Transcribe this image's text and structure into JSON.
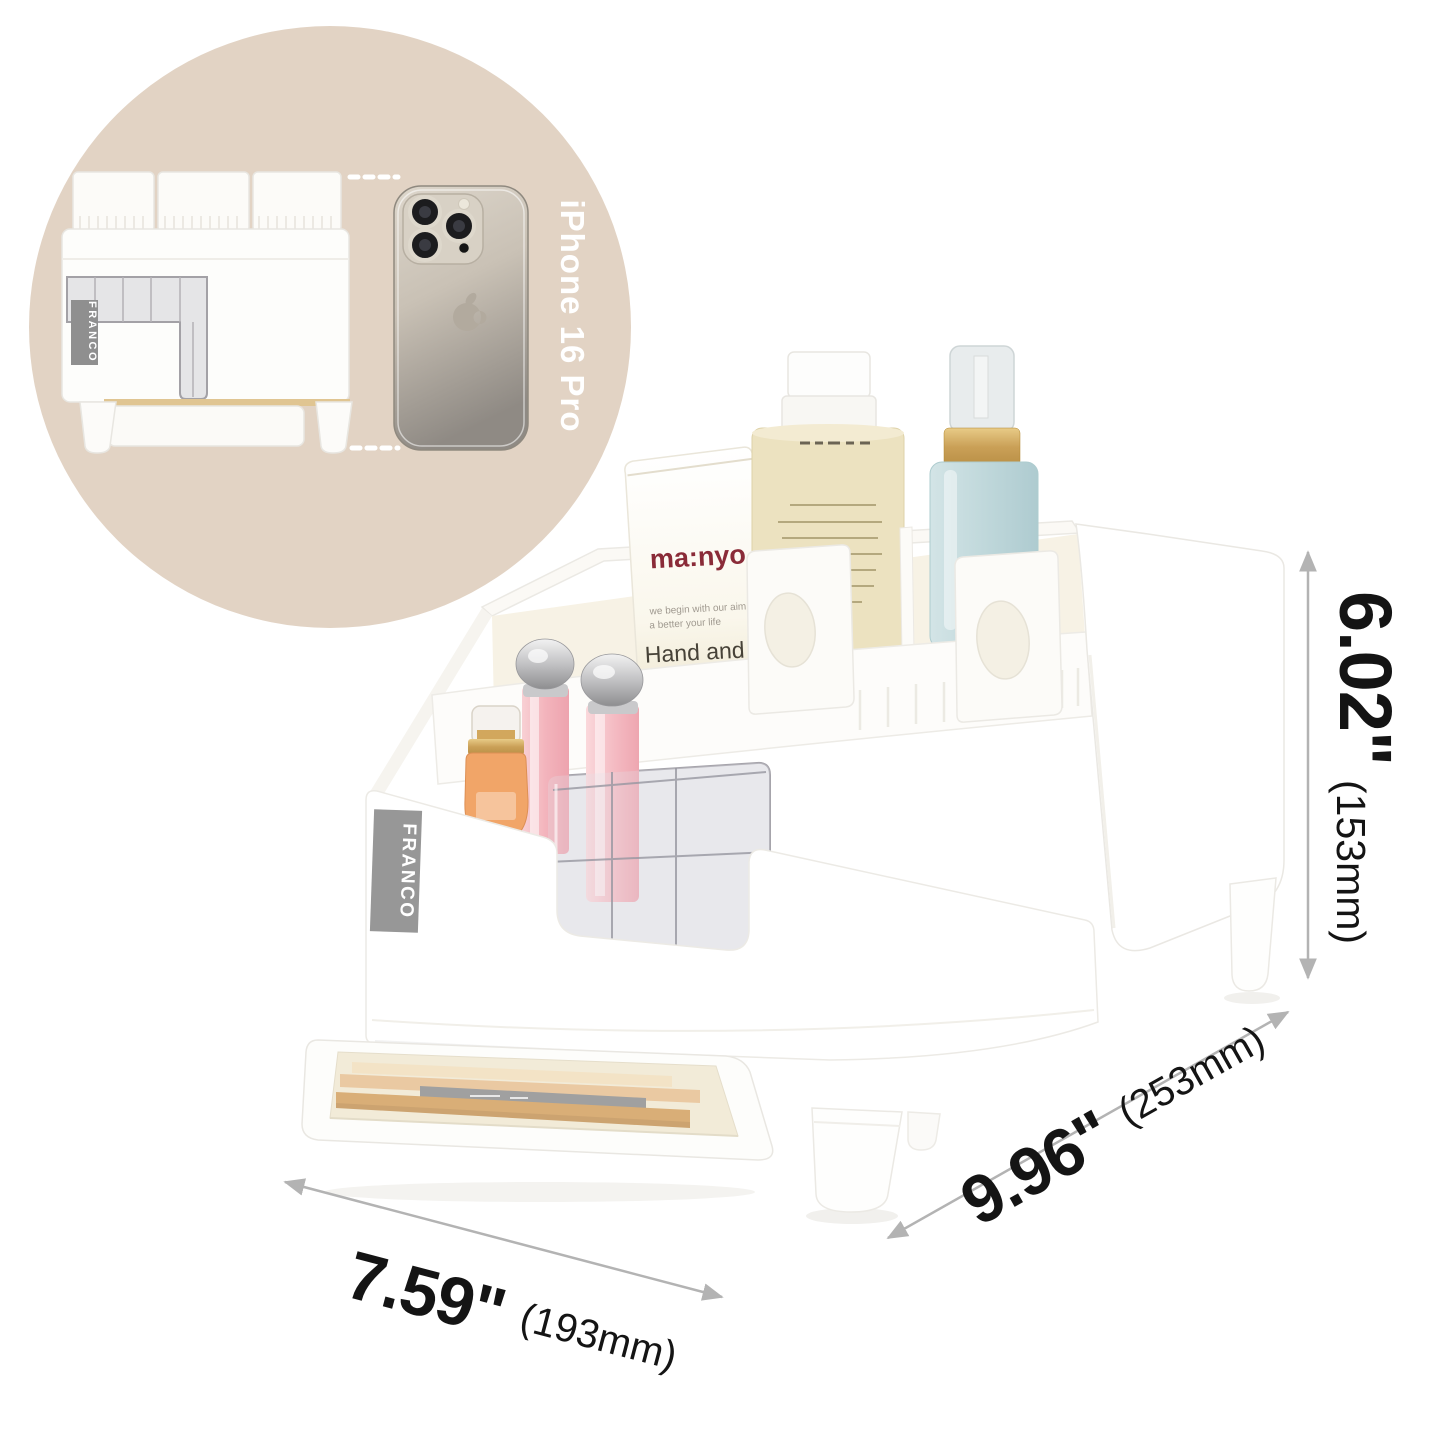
{
  "brand": {
    "name": "FRANCO"
  },
  "inset": {
    "phone_label": "iPhone 16 Pro"
  },
  "tube": {
    "brand": "ma:nyo",
    "tagline1": "we begin with our aim",
    "tagline2": "a better your life",
    "title1": "Hand and Nail",
    "title2": "Treatment"
  },
  "dimensions": {
    "height_in": "6.02\"",
    "height_mm": "(153mm)",
    "depth_in": "9.96\"",
    "depth_mm": "(253mm)",
    "width_in": "7.59\"",
    "width_mm": "(193mm)"
  },
  "colors": {
    "circle_bg": "#e2d3c4",
    "label_gray": "#969696",
    "dimension_line": "#b3b3b3",
    "dimension_text": "#141414",
    "manyo_red": "#8a2b38",
    "gold": "#c9a254",
    "lipstick_pink": "#f2b3bb",
    "bottle_orange": "#f1a568",
    "spray_blue": "#c3d9dc"
  }
}
